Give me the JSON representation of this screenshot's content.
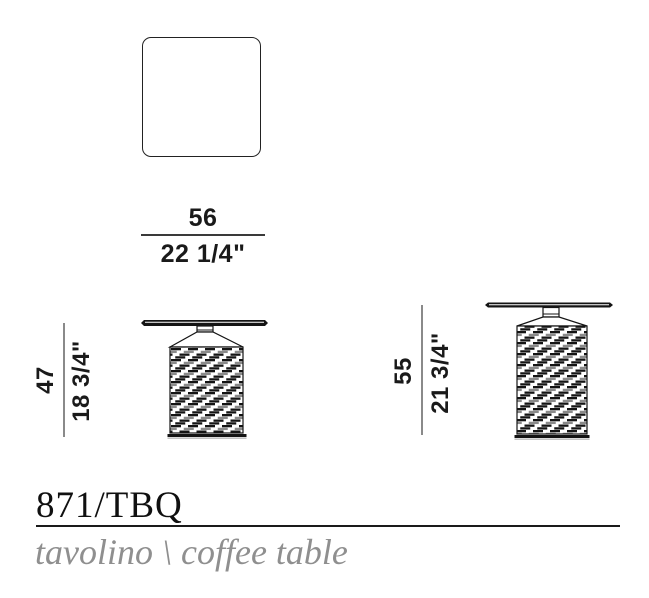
{
  "document": {
    "product_code": "871/TBQ",
    "subtitle": "tavolino \\ coffee table"
  },
  "dimensions": {
    "width": {
      "cm": "56",
      "inch": "22 1/4\""
    },
    "height_left": {
      "cm": "47",
      "inch": "18 3/4\""
    },
    "height_right": {
      "cm": "55",
      "inch": "21 3/4\""
    }
  },
  "colors": {
    "ink": "#1a1a1a",
    "dimension_line_gray": "#8a8a8a",
    "pattern_accent_gray": "#8a8a8a",
    "subtitle_gray": "#8f8f8f"
  }
}
